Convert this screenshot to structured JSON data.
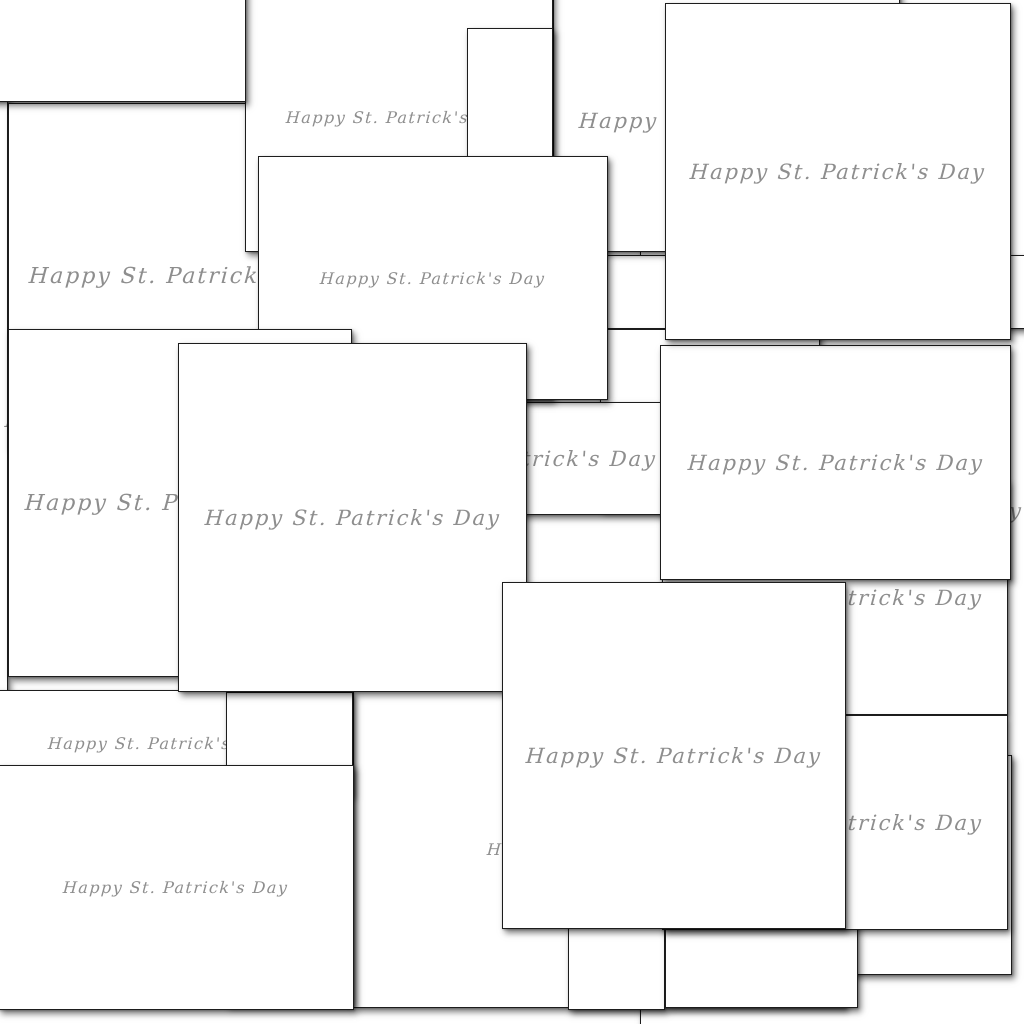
{
  "canvas": {
    "width": 1024,
    "height": 1024,
    "background": "#ffffff"
  },
  "style": {
    "card_background": "#ffffff",
    "card_border_color": "#1d1d1d",
    "text_color": "#8e8e8e",
    "shadow": "3px 4px 6px rgba(0,0,0,.50)"
  },
  "greeting_text": "Happy St. Patrick's Day",
  "cards": [
    {
      "id": "filler-right",
      "x": 640,
      "y": -12,
      "w": 470,
      "h": 1046,
      "z": 1,
      "font": 21
    },
    {
      "id": "filler-left",
      "x": -200,
      "y": 60,
      "w": 208,
      "h": 720,
      "z": 2,
      "font": 21
    },
    {
      "id": "filler-mid-gap",
      "x": 500,
      "y": 390,
      "w": 180,
      "h": 195,
      "z": 3,
      "font": 21
    },
    {
      "id": "bottom-right-back",
      "x": 680,
      "y": 755,
      "w": 332,
      "h": 220,
      "z": 4,
      "font": 21
    },
    {
      "id": "bottom-strip-wide",
      "x": 353,
      "y": 690,
      "w": 493,
      "h": 318,
      "z": 5,
      "font": 16
    },
    {
      "id": "bottom-strip-narrow",
      "x": 568,
      "y": 730,
      "w": 97,
      "h": 280,
      "z": 6,
      "font": 21
    },
    {
      "id": "bottom-strip-right",
      "x": 665,
      "y": 718,
      "w": 193,
      "h": 290,
      "z": 7,
      "font": 16
    },
    {
      "id": "mid-strip-upper",
      "x": 600,
      "y": 255,
      "w": 440,
      "h": 74,
      "z": 8,
      "font": 16
    },
    {
      "id": "mid-strip-lower",
      "x": 600,
      "y": 329,
      "w": 220,
      "h": 181,
      "z": 9,
      "font": 16
    },
    {
      "id": "upper-left",
      "x": 8,
      "y": 103,
      "w": 351,
      "h": 346,
      "z": 10,
      "font": 22
    },
    {
      "id": "mid-cut-text",
      "x": 352,
      "y": 402,
      "w": 313,
      "h": 113,
      "z": 11,
      "font": 21
    },
    {
      "id": "top-mid-right",
      "x": 553,
      "y": -10,
      "w": 347,
      "h": 262,
      "z": 12,
      "font": 21
    },
    {
      "id": "top-second",
      "x": 245,
      "y": -18,
      "w": 308,
      "h": 270,
      "z": 13,
      "font": 16
    },
    {
      "id": "left-low-cut",
      "x": -30,
      "y": 690,
      "w": 382,
      "h": 106,
      "z": 14,
      "font": 16
    },
    {
      "id": "low-small-box",
      "x": 226,
      "y": 692,
      "w": 127,
      "h": 313,
      "z": 15,
      "font": 16
    },
    {
      "id": "right-mid-cut",
      "x": 662,
      "y": 480,
      "w": 346,
      "h": 235,
      "z": 16,
      "font": 21
    },
    {
      "id": "right-low-cut",
      "x": 662,
      "y": 715,
      "w": 346,
      "h": 215,
      "z": 17,
      "font": 21
    },
    {
      "id": "top-narrow",
      "x": 467,
      "y": 28,
      "w": 86,
      "h": 372,
      "z": 18,
      "font": 16
    },
    {
      "id": "top-left-corner",
      "x": -160,
      "y": -150,
      "w": 406,
      "h": 252,
      "z": 19,
      "font": 21
    },
    {
      "id": "center-top",
      "x": 258,
      "y": 156,
      "w": 350,
      "h": 244,
      "z": 20,
      "font": 16
    },
    {
      "id": "center-right",
      "x": 660,
      "y": 345,
      "w": 351,
      "h": 235,
      "z": 21,
      "font": 21
    },
    {
      "id": "top-right",
      "x": 665,
      "y": 3,
      "w": 346,
      "h": 337,
      "z": 22,
      "font": 21
    },
    {
      "id": "left-tall",
      "x": 8,
      "y": 329,
      "w": 344,
      "h": 348,
      "z": 23,
      "font": 22
    },
    {
      "id": "big-center",
      "x": 178,
      "y": 343,
      "w": 349,
      "h": 349,
      "z": 24,
      "font": 21
    },
    {
      "id": "bottom-left",
      "x": -2,
      "y": 765,
      "w": 356,
      "h": 245,
      "z": 25,
      "font": 16
    },
    {
      "id": "bottom-center",
      "x": 502,
      "y": 582,
      "w": 344,
      "h": 347,
      "z": 26,
      "font": 21
    }
  ]
}
